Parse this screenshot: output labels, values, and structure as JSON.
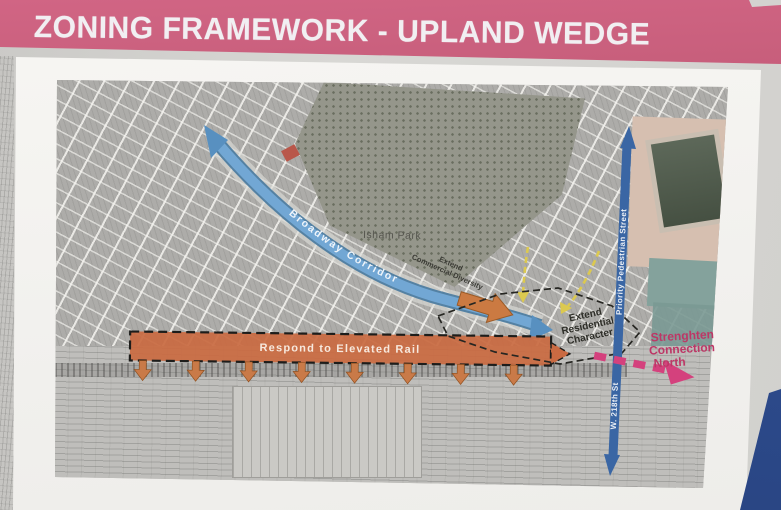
{
  "header": {
    "title": "ZONING FRAMEWORK - UPLAND WEDGE",
    "bg_color": "#ce6380",
    "text_color": "#f1eff2"
  },
  "map": {
    "park_label": "Isham Park",
    "broadway_corridor": {
      "label": "Broadway Corridor",
      "band_color": "#72a7d4"
    },
    "elevated_rail": {
      "label": "Respond to Elevated Rail",
      "fill_color": "#c96a42"
    },
    "commercial_diversity": {
      "line1": "Extend",
      "line2": "Commercial Diversity"
    },
    "residential_character": {
      "line1": "Extend",
      "line2": "Residential",
      "line3": "Character"
    },
    "pedestrian_street": {
      "label": "Priority Pedestrian Street",
      "street_name": "W. 218th St",
      "arrow_color": "#3a66a4"
    },
    "connection_north": {
      "line1": "Strenghten",
      "line2": "Connection",
      "line3": "North",
      "arrow_color": "#d4417d"
    }
  }
}
